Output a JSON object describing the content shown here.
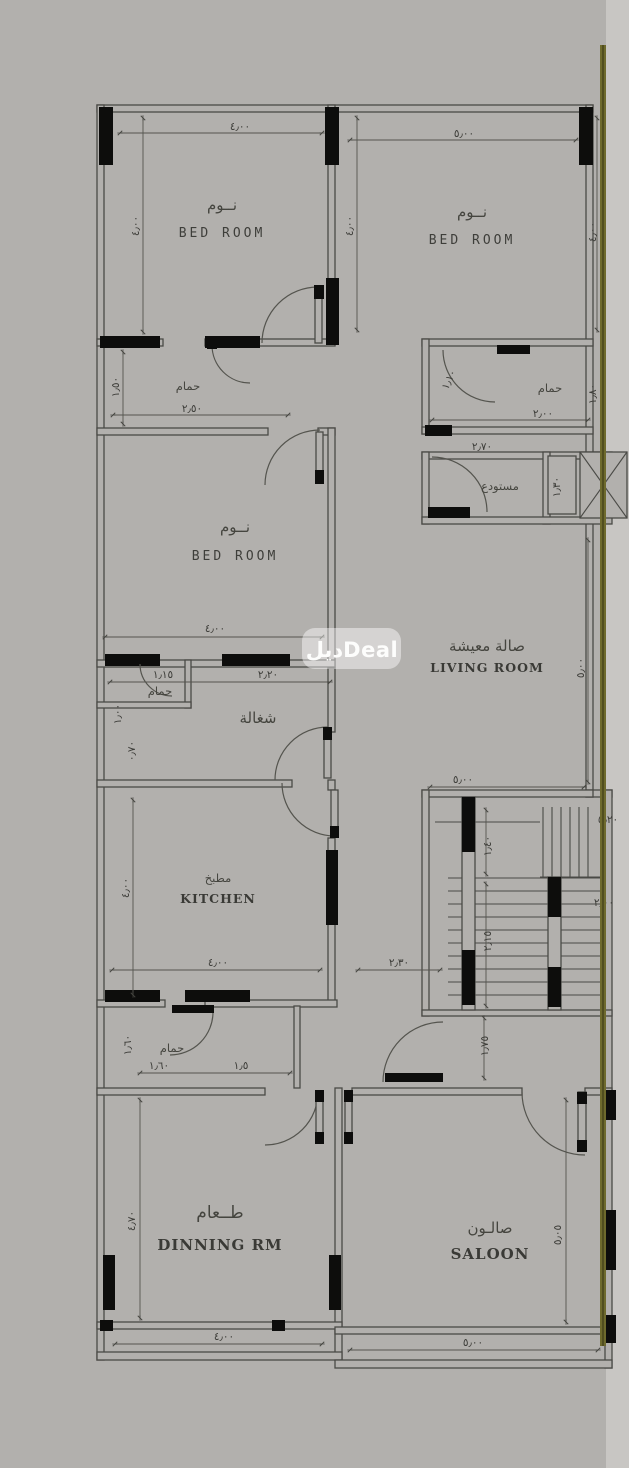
{
  "watermark": {
    "text": "ديلDeal"
  },
  "colors": {
    "background": "#b2b0ad",
    "right_strip": "#c8c6c3",
    "line": "#4a4a46",
    "wall_fill": "#0d0d0c",
    "annotation_line": "#6e6a2d",
    "watermark_bg": "rgba(255,255,255,0.45)",
    "watermark_text": "#fdfdfc"
  },
  "rooms": {
    "bedroom_tl": {
      "ar": "نــوم",
      "en": "BED ROOM"
    },
    "bedroom_tr": {
      "ar": "نــوم",
      "en": "BED ROOM"
    },
    "bedroom_mid": {
      "ar": "نــوم",
      "en": "BED ROOM"
    },
    "bathroom_tl": {
      "ar": "حمام"
    },
    "bathroom_tr": {
      "ar": "حمام"
    },
    "storage": {
      "ar": "مستودع"
    },
    "living": {
      "ar": "صالة معيشة",
      "en": "LIVING ROOM"
    },
    "maid": {
      "ar": "شغالة"
    },
    "maid_bath": {
      "ar": "حمام"
    },
    "kitchen": {
      "ar": "مطبخ",
      "en": "KITCHEN"
    },
    "bath_bottom": {
      "ar": "حمام"
    },
    "dining": {
      "ar": "طــعام",
      "en": "DINNING RM"
    },
    "saloon": {
      "ar": "صالـون",
      "en": "SALOON"
    }
  },
  "dims": {
    "tl_width": "٤٫٠٠",
    "tr_width": "٥٫٠٠",
    "tl_height": "٤٫٠٠",
    "tr_height_left": "٤٫٠٠",
    "tr_height_right": "٤٫٠٠",
    "bath_tl_width": "٢٫٥٠",
    "bath_tl_height": "١٫٥٠",
    "bath_tr_width": "٢٫٠٠",
    "bath_tr_door": "١٫١٠",
    "bath_tr_height": "١٫٨٠",
    "storage_width": "٢٫٧٠",
    "storage_height": "١٫٣٠",
    "bedroom_mid_width": "٤٫٠٠",
    "maid_bath_width": "١٫١٥",
    "maid_width": "٢٫٢٠",
    "maid_left_upper": "١٫٠٠",
    "maid_left_lower": "٠٫٧٠",
    "living_width": "٥٫٠٠",
    "living_height": "٥٫٠٠",
    "kitchen_width": "٤٫٠٠",
    "kitchen_height": "٤٫٠٠",
    "kitchen_door": "٢٫٣٠",
    "stair_width": "٥٫٢٠",
    "stair_flight": "١٫٤٠",
    "stair_mid": "٢٫١٥",
    "stair_right": "٢٫٠٠",
    "hall_door": "١٫٧٥",
    "bath_b_width": "١٫٦٠",
    "bath_b_door": "١٫٥",
    "bath_b_height": "١٫٦٠",
    "dining_height": "٤٫٧٠",
    "dining_width": "٤٫٠٠",
    "saloon_height": "٥٫٠٥",
    "saloon_width": "٥٫٠٠"
  }
}
